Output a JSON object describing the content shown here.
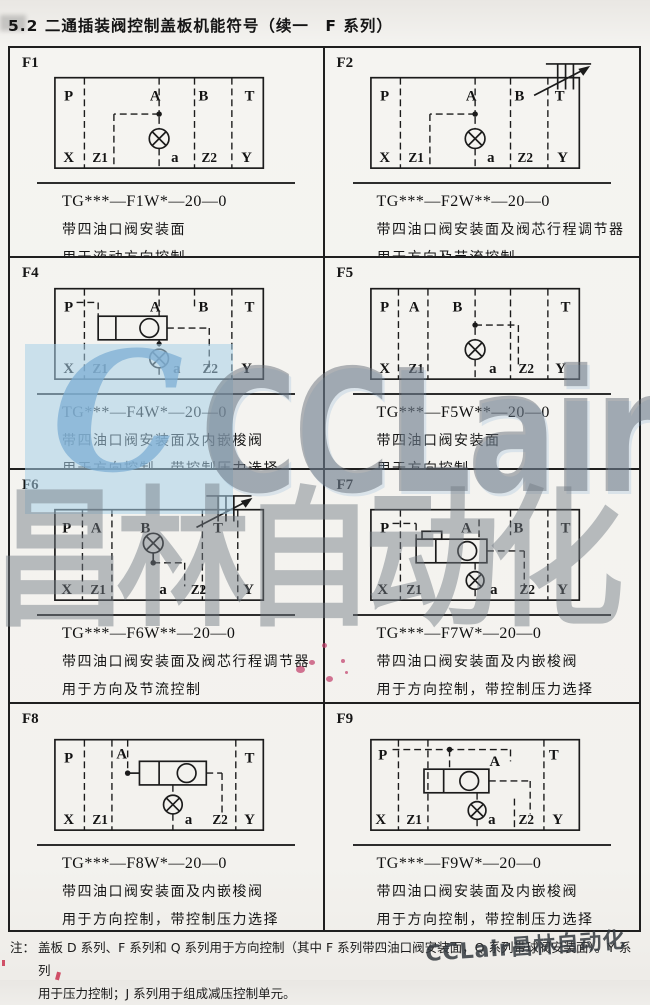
{
  "page": {
    "title": "5.2 二通插装阀控制盖板机能符号（续一　F 系列）",
    "note": {
      "label": "注：",
      "line1": "盖板 D 系列、F 系列和 Q 系列用于方向控制（其中 F 系列带四油口阀安装面，Q 系列带球阀安装面）。Y 系列",
      "line2": "用于压力控制；J 系列用于组成减压控制单元。"
    },
    "watermark": {
      "logo_letter": "C",
      "brand": "CCLair",
      "brand_cn": "昌林自动化",
      "corner": "CCLair昌林自动化"
    },
    "colors": {
      "watermark_blue": "#a8cfe8",
      "watermark_gray": "#747b83",
      "ink_red": "#c03a68",
      "line_black": "#1b1b1b"
    }
  },
  "cells": [
    {
      "id": "F1",
      "code": "TG***—F1W*—20—0",
      "desc1": "带四油口阀安装面",
      "desc2": "用于液动方向控制",
      "top": [
        "P",
        "A",
        "B",
        "T"
      ],
      "bottom": [
        "X",
        "Z1",
        "a",
        "Z2",
        "Y"
      ]
    },
    {
      "id": "F2",
      "code": "TG***—F2W**—20—0",
      "desc1": "带四油口阀安装面及阀芯行程调节器",
      "desc2": "用于方向及节流控制",
      "top": [
        "P",
        "A",
        "B",
        "T"
      ],
      "bottom": [
        "X",
        "Z1",
        "a",
        "Z2",
        "Y"
      ]
    },
    {
      "id": "F4",
      "code": "TG***—F4W*—20—0",
      "desc1": "带四油口阀安装面及内嵌梭阀",
      "desc2": "用于方向控制，带控制压力选择",
      "top": [
        "P",
        "A",
        "B",
        "T"
      ],
      "bottom": [
        "X",
        "Z1",
        "a",
        "Z2",
        "Y"
      ]
    },
    {
      "id": "F5",
      "code": "TG***—F5W**—20—0",
      "desc1": "带四油口阀安装面",
      "desc2": "用于方向控制",
      "top": [
        "P",
        "A",
        "B",
        "T"
      ],
      "bottom": [
        "X",
        "Z1",
        "a",
        "Z2",
        "Y"
      ]
    },
    {
      "id": "F6",
      "code": "TG***—F6W**—20—0",
      "desc1": "带四油口阀安装面及阀芯行程调节器",
      "desc2": "用于方向及节流控制",
      "top": [
        "P",
        "A",
        "B",
        "T"
      ],
      "bottom": [
        "X",
        "Z1",
        "a",
        "Z2",
        "Y"
      ]
    },
    {
      "id": "F7",
      "code": "TG***—F7W*—20—0",
      "desc1": "带四油口阀安装面及内嵌梭阀",
      "desc2": "用于方向控制，带控制压力选择",
      "top": [
        "P",
        "A",
        "B",
        "T"
      ],
      "bottom": [
        "X",
        "Z1",
        "a",
        "Z2",
        "Y"
      ]
    },
    {
      "id": "F8",
      "code": "TG***—F8W*—20—0",
      "desc1": "带四油口阀安装面及内嵌梭阀",
      "desc2": "用于方向控制，带控制压力选择",
      "top": [
        "P",
        "A",
        "T"
      ],
      "bottom": [
        "X",
        "Z1",
        "a",
        "Z2",
        "Y"
      ]
    },
    {
      "id": "F9",
      "code": "TG***—F9W*—20—0",
      "desc1": "带四油口阀安装面及内嵌梭阀",
      "desc2": "用于方向控制，带控制压力选择",
      "top": [
        "P",
        "A",
        "T"
      ],
      "bottom": [
        "X",
        "Z1",
        "a",
        "Z2",
        "Y"
      ]
    }
  ]
}
